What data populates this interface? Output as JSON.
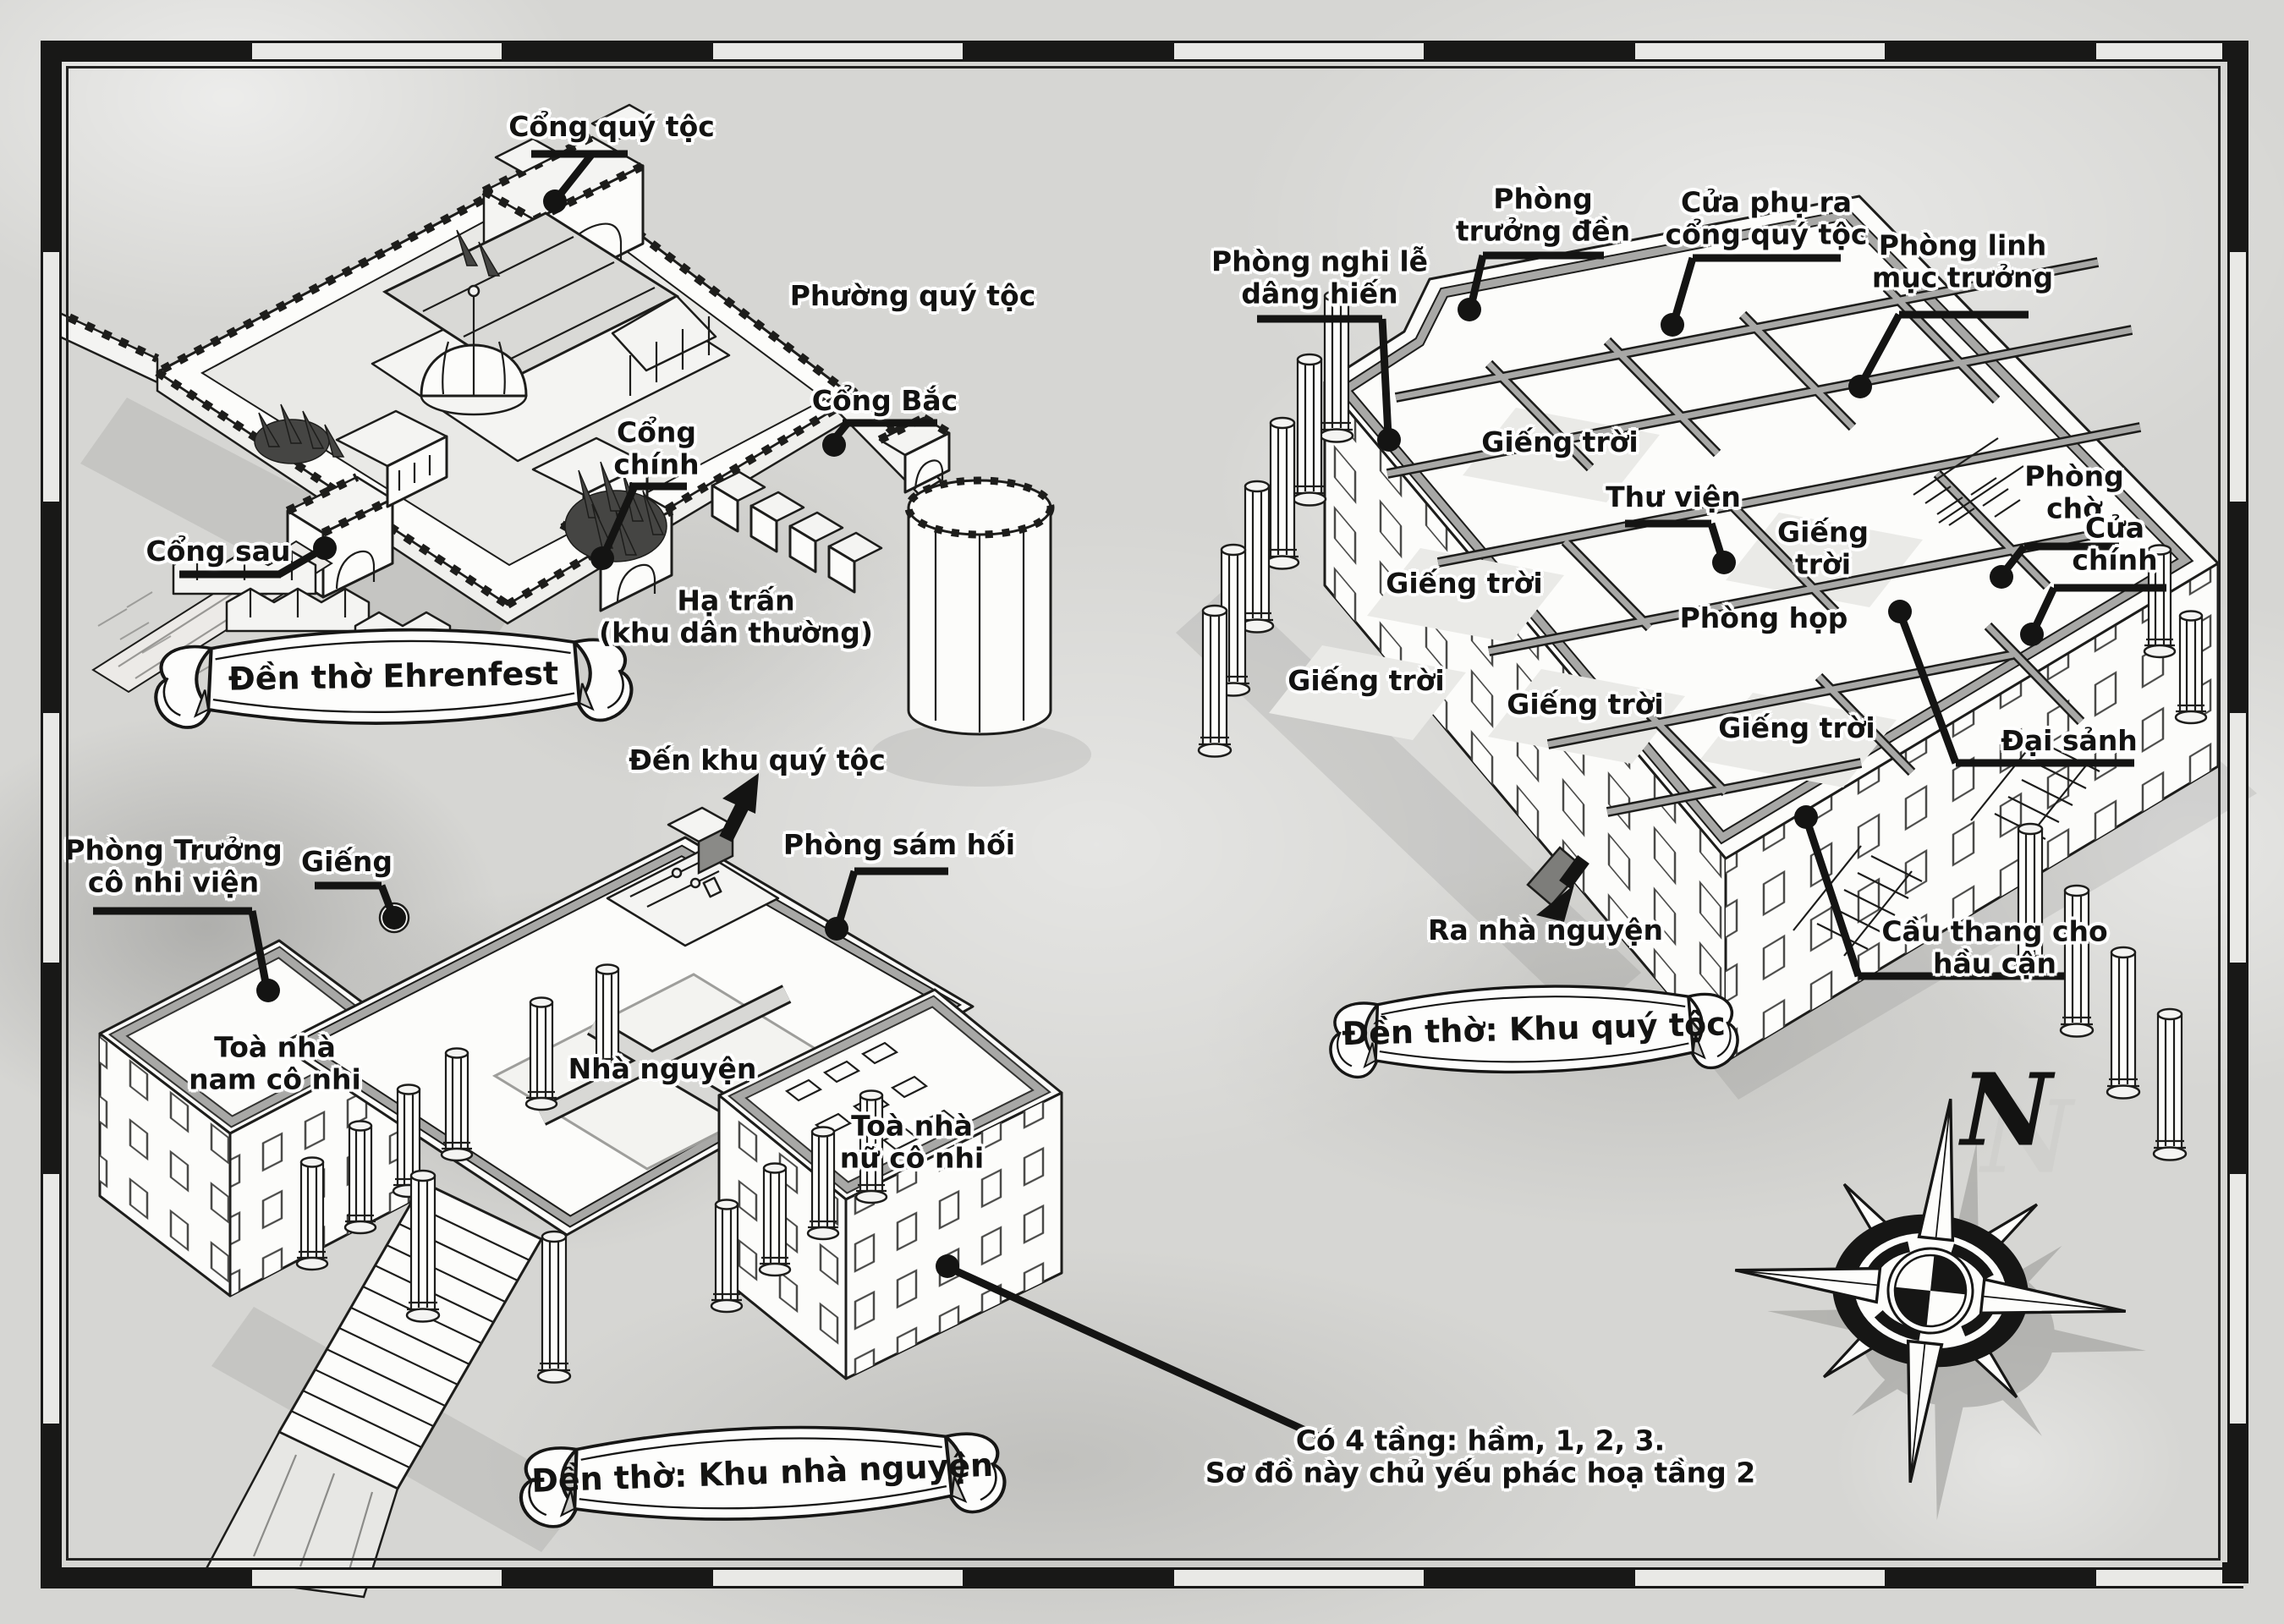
{
  "banners": {
    "overview": "Đền thờ Ehrenfest",
    "noble": "Đền thờ: Khu quý tộc",
    "chapel": "Đền thờ: Khu nhà nguyện"
  },
  "overview": {
    "labels": {
      "noble_gate": "Cổng quý tộc",
      "noble_quarter": "Phường quý tộc",
      "north_gate": "Cổng Bắc",
      "main_gate": "Cổng\nchính",
      "back_gate": "Cổng sau",
      "lower_town": "Hạ trấn\n(khu dân thường)"
    }
  },
  "noble": {
    "labels": {
      "dedication_room": "Phòng nghi lễ\ndâng hiến",
      "temple_head_room": "Phòng\ntrưởng đền",
      "side_door": "Cửa phụ ra\ncổng quý tộc",
      "head_priest_room": "Phòng linh\nmục trưởng",
      "waiting_room": "Phòng\nchờ",
      "main_door": "Cửa\nchính",
      "library": "Thư viện",
      "meeting_room": "Phòng họp",
      "great_hall": "Đại sảnh",
      "to_chapel": "Ra nhà nguyện",
      "servant_stairs": "Cầu thang cho hầu cận"
    },
    "skylights": [
      "Giếng trời",
      "Giếng trời",
      "Giếng trời",
      "Giếng trời",
      "Giếng trời",
      "Giếng trời"
    ]
  },
  "chapel": {
    "labels": {
      "to_noble_area": "Đến khu quý tộc",
      "repentance_room": "Phòng sám hối",
      "orphanage_director_room": "Phòng Trưởng\ncô nhi viện",
      "well": "Giếng",
      "boys_building": "Toà nhà\nnam cô nhi",
      "chapel_hall": "Nhà nguyện",
      "girls_building": "Toà nhà\nnữ cô nhi"
    }
  },
  "note": "Có 4 tầng: hầm, 1, 2, 3.\nSơ đồ này chủ yếu phác hoạ tầng 2",
  "compass": {
    "north": "N"
  },
  "colors": {
    "paper": "#d6d6d3",
    "ink": "#1a1a19",
    "wall": "#a6a6a4",
    "roof": "#cfcfcd"
  }
}
